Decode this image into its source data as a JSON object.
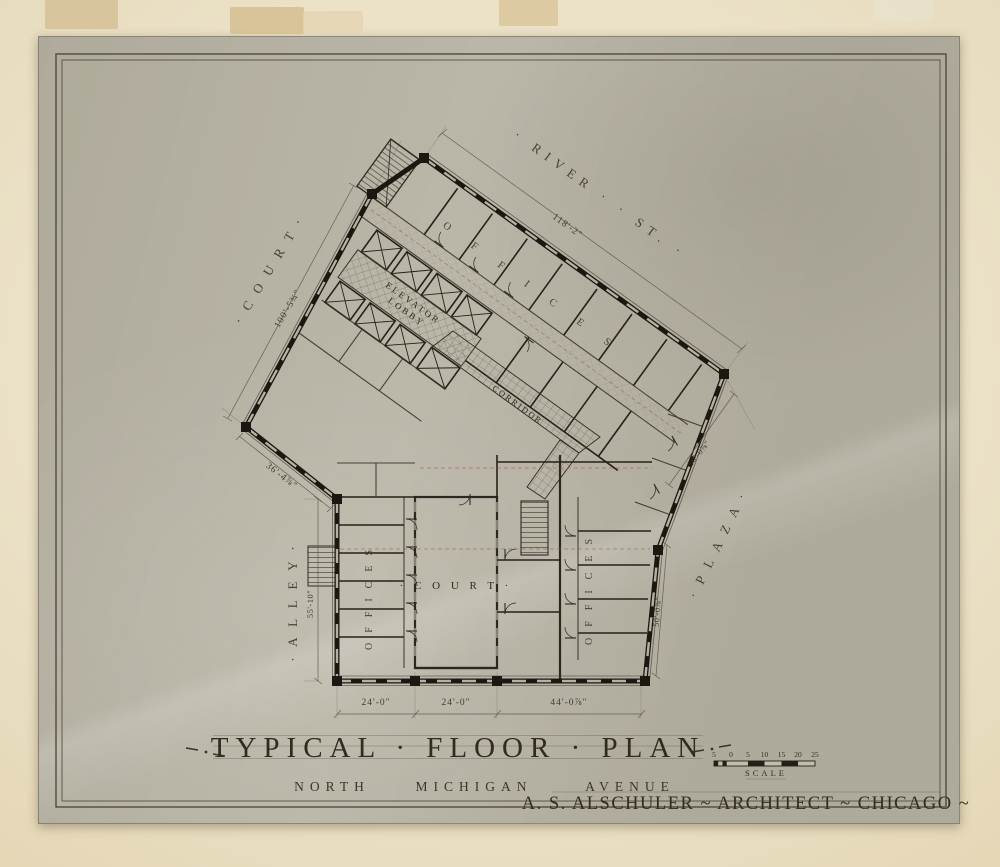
{
  "artwork": {
    "streets": {
      "river_st": "· RIVER ·  · ST. ·",
      "court": "· C O U R T ·",
      "alley": "· A L L E Y ·",
      "plaza": "· P L A Z A ·"
    },
    "rooms": {
      "court_center": "· C O U R T ·",
      "elevator_line1": "ELEVATOR",
      "elevator_line2": "LOBBY",
      "corridor": "CORRIDOR",
      "offices": "OFFICES"
    },
    "dimensions": {
      "river_frontage": "118'-2\"",
      "court_frontage": "100'-5¾\"",
      "southwest_diagonal": "36'-4⅞\"",
      "alley_frontage": "55'-10\"",
      "bottom_left_bay": "24'-0\"",
      "bottom_court_bay": "24'-0\"",
      "bottom_right_bay": "44'-0⅞\"",
      "plaza_diagonal": "50'-0⅞\"",
      "plaza_vertical": "50'-0⅞\""
    },
    "title_block": {
      "title": "TYPICAL · FLOOR · PLAN",
      "address": [
        "NORTH",
        "MICHIGAN",
        "AVENUE"
      ],
      "architect": "A. S. ALSCHULER ~ ARCHITECT ~ CHICAGO ~",
      "scale_label": "SCALE",
      "scale_ticks": [
        "5",
        "0",
        "5",
        "10",
        "15",
        "20",
        "25"
      ]
    },
    "colors": {
      "mat": "#e9dfc4",
      "sheet": "#b6b2a3",
      "ink": "#2f2a21",
      "red_axis": "#a05545",
      "tape": "#d9c49a"
    }
  }
}
